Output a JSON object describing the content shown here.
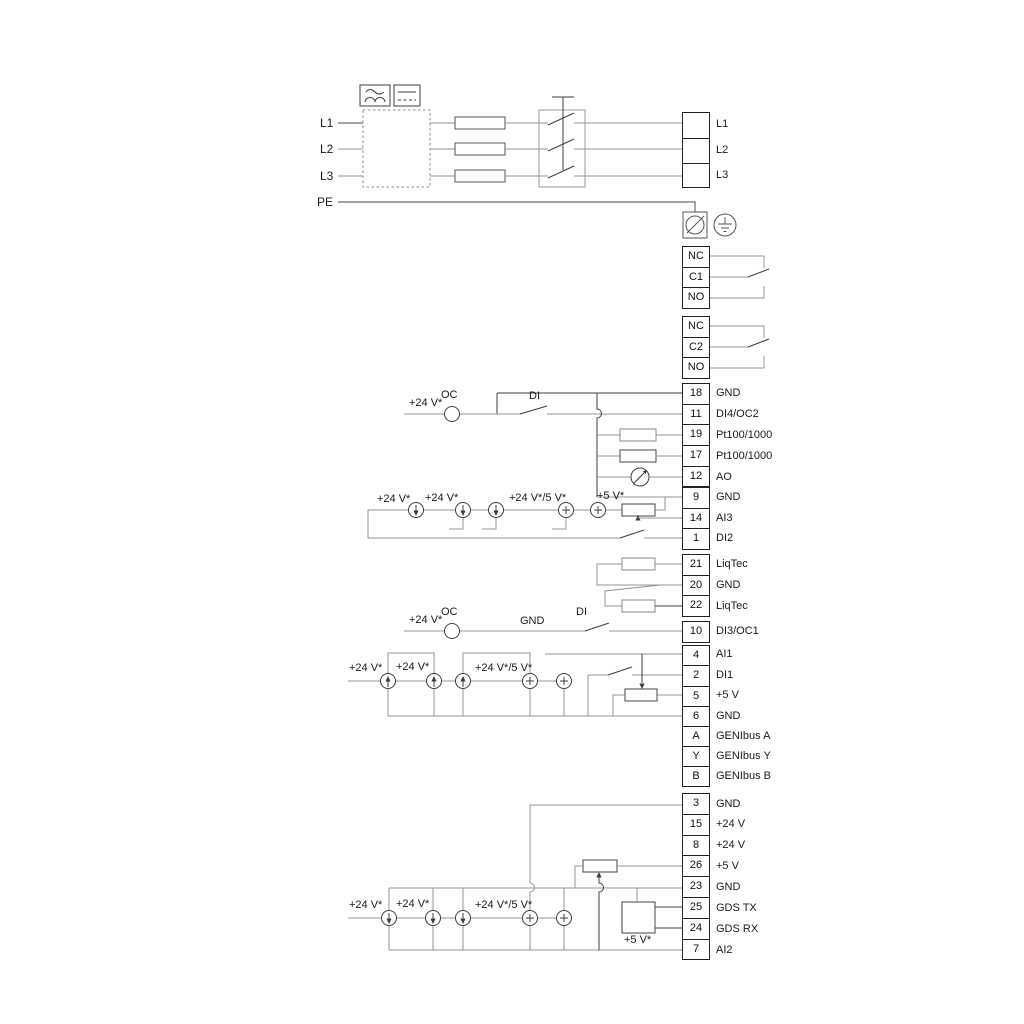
{
  "colors": {
    "wire": "#949494",
    "dark": "#3c3c3c",
    "border": "#222222",
    "text": "#1a1a1a"
  },
  "phases": {
    "l1": "L1",
    "l2": "L2",
    "l3": "L3",
    "pe": "PE"
  },
  "annotations": {
    "v24": "+24 V*",
    "v24_5": "+24 V*/5 V*",
    "v5": "+5 V*",
    "oc": "OC",
    "di": "DI",
    "gnd": "GND"
  },
  "symbols": [
    "ac-symbol",
    "dc-symbol",
    "fuse",
    "disconnect-switch",
    "screw-terminal",
    "earth-ground-symbol",
    "current-source-arrow",
    "voltage-source-plus",
    "potentiometer",
    "resistor",
    "analog-output-meter",
    "changeover-contact"
  ],
  "strips": {
    "power": {
      "labels": [
        "L1",
        "L2",
        "L3"
      ]
    },
    "relay1": {
      "cells": [
        "NC",
        "C1",
        "NO"
      ]
    },
    "relay2": {
      "cells": [
        "NC",
        "C2",
        "NO"
      ]
    },
    "io1": {
      "rows": [
        [
          "18",
          "GND"
        ],
        [
          "11",
          "DI4/OC2"
        ],
        [
          "19",
          "Pt100/1000"
        ],
        [
          "17",
          "Pt100/1000"
        ],
        [
          "12",
          "AO"
        ]
      ]
    },
    "io2": {
      "rows": [
        [
          "9",
          "GND"
        ],
        [
          "14",
          "AI3"
        ],
        [
          "1",
          "DI2"
        ]
      ]
    },
    "liqtec": {
      "rows": [
        [
          "21",
          "LiqTec"
        ],
        [
          "20",
          "GND"
        ],
        [
          "22",
          "LiqTec"
        ]
      ]
    },
    "di3": {
      "rows": [
        [
          "10",
          "DI3/OC1"
        ]
      ]
    },
    "ai1": {
      "rows": [
        [
          "4",
          "AI1"
        ],
        [
          "2",
          "DI1"
        ],
        [
          "5",
          "+5 V"
        ],
        [
          "6",
          "GND"
        ]
      ]
    },
    "genibus": {
      "rows": [
        [
          "A",
          "GENIbus A"
        ],
        [
          "Y",
          "GENIbus Y"
        ],
        [
          "B",
          "GENIbus B"
        ]
      ]
    },
    "power24": {
      "rows": [
        [
          "3",
          "GND"
        ],
        [
          "15",
          "+24 V"
        ],
        [
          "8",
          "+24 V"
        ],
        [
          "26",
          "+5 V"
        ],
        [
          "23",
          "GND"
        ],
        [
          "25",
          "GDS TX"
        ],
        [
          "24",
          "GDS RX"
        ],
        [
          "7",
          "AI2"
        ]
      ]
    }
  }
}
